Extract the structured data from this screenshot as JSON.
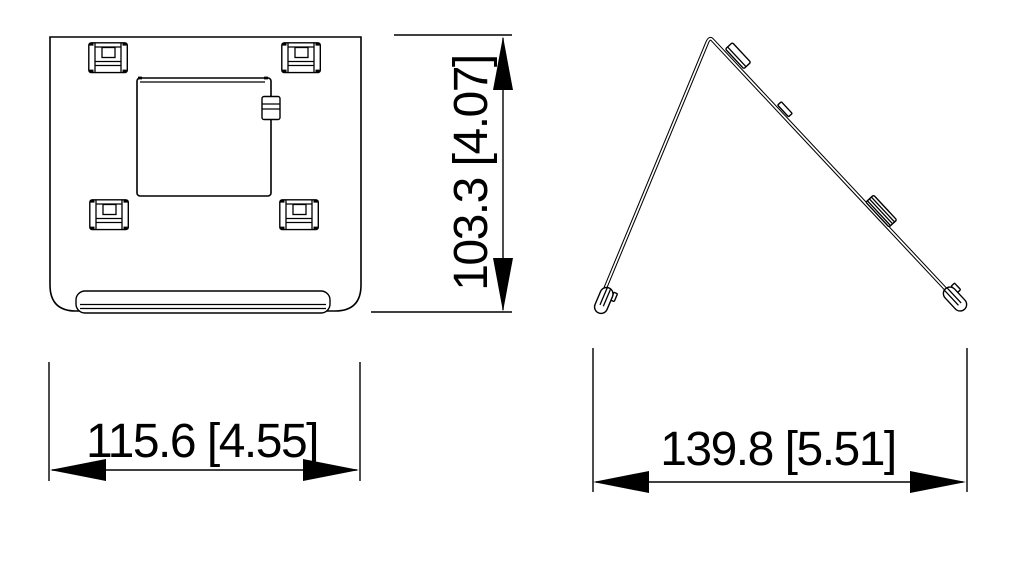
{
  "page": {
    "background_color": "#ffffff",
    "line_color": "#000000"
  },
  "dimensions": {
    "front_height": {
      "label": "103.3 [4.07]",
      "value_mm": "103.3",
      "value_in": "4.07",
      "orientation": "vertical"
    },
    "front_width": {
      "label": "115.6 [4.55]",
      "value_mm": "115.6",
      "value_in": "4.55",
      "orientation": "horizontal"
    },
    "side_depth": {
      "label": "139.8 [5.51]",
      "value_mm": "139.8",
      "value_in": "5.51",
      "orientation": "horizontal"
    }
  }
}
